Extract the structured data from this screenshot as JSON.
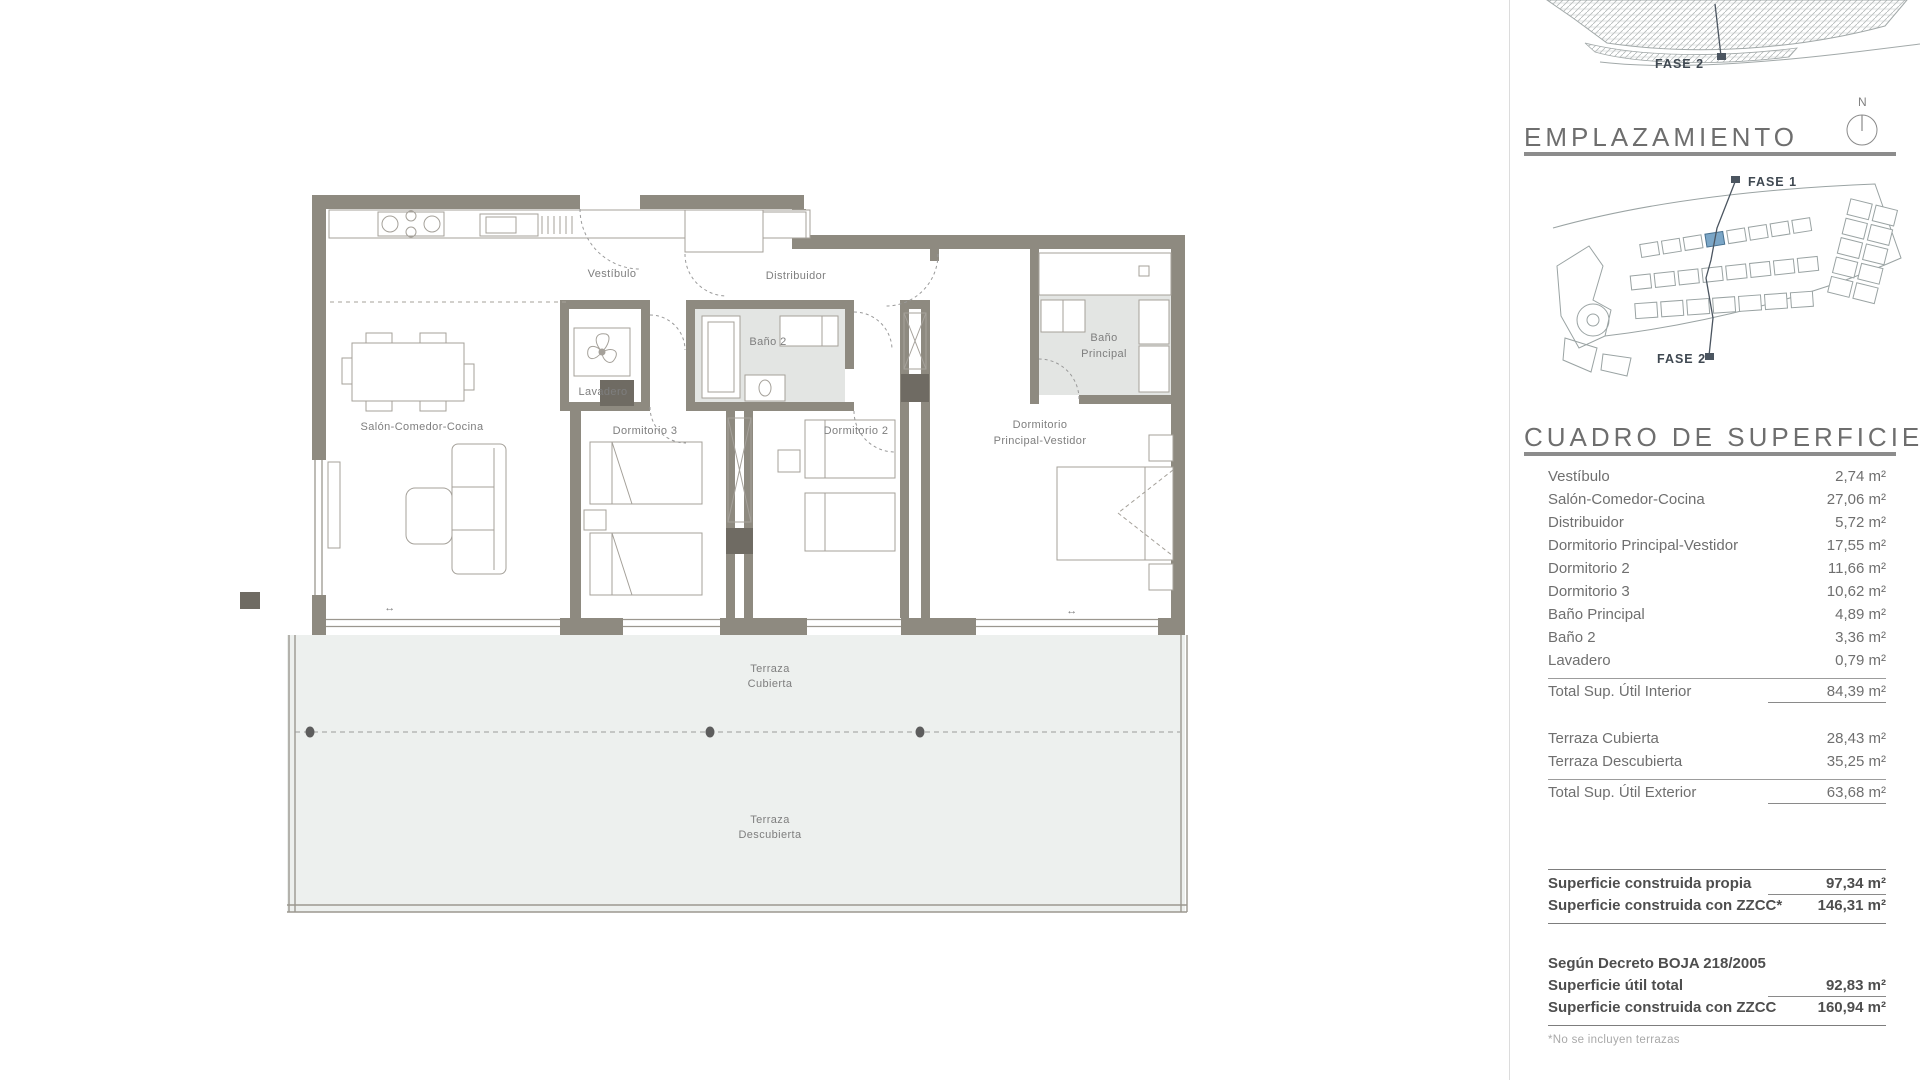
{
  "headings": {
    "emplazamiento": "EMPLAZAMIENTO",
    "cuadro": "CUADRO DE SUPERFICIES"
  },
  "compass": {
    "north": "N"
  },
  "top_map": {
    "fase2": "FASE 2"
  },
  "site_plan": {
    "fase1": "FASE 1",
    "fase2": "FASE 2",
    "highlight_color": "#7ba6c7"
  },
  "floor_plan": {
    "labels": {
      "vestibulo": "Vestíbulo",
      "distribuidor": "Distribuidor",
      "bano2": "Baño 2",
      "lavadero": "Lavadero",
      "salon": "Salón-Comedor-Cocina",
      "dorm3": "Dormitorio 3",
      "dorm2": "Dormitorio 2",
      "dormp1": "Dormitorio",
      "dormp2": "Principal-Vestidor",
      "banop1": "Baño",
      "banop2": "Principal",
      "terraza_c1": "Terraza",
      "terraza_c2": "Cubierta",
      "terraza_d1": "Terraza",
      "terraza_d2": "Descubierta",
      "slide_arrow": "↔"
    },
    "colors": {
      "wall": "#8e8a80",
      "wall_dark": "#6f6b63",
      "terrace_fill": "#edf0ee",
      "bath_floor": "#e3e5e3"
    }
  },
  "surfaces": {
    "interior": [
      {
        "label": "Vestíbulo",
        "value": "2,74 m²"
      },
      {
        "label": "Salón-Comedor-Cocina",
        "value": "27,06 m²"
      },
      {
        "label": "Distribuidor",
        "value": "5,72 m²"
      },
      {
        "label": "Dormitorio Principal-Vestidor",
        "value": "17,55 m²"
      },
      {
        "label": "Dormitorio 2",
        "value": "11,66 m²"
      },
      {
        "label": "Dormitorio 3",
        "value": "10,62 m²"
      },
      {
        "label": "Baño Principal",
        "value": "4,89 m²"
      },
      {
        "label": "Baño 2",
        "value": "3,36 m²"
      },
      {
        "label": "Lavadero",
        "value": "0,79 m²"
      }
    ],
    "interior_total": {
      "label": "Total Sup. Útil Interior",
      "value": "84,39 m²"
    },
    "exterior": [
      {
        "label": "Terraza Cubierta",
        "value": "28,43 m²"
      },
      {
        "label": "Terraza Descubierta",
        "value": "35,25 m²"
      }
    ],
    "exterior_total": {
      "label": "Total Sup. Útil Exterior",
      "value": "63,68 m²"
    },
    "construida": [
      {
        "label": "Superficie construida propia",
        "value": "97,34 m²"
      },
      {
        "label": "Superficie construida con ZZCC*",
        "value": "146,31 m²"
      }
    ],
    "decreto_heading": "Según Decreto BOJA 218/2005",
    "decreto": [
      {
        "label": "Superficie útil total",
        "value": "92,83 m²"
      },
      {
        "label": "Superficie construida con ZZCC",
        "value": "160,94 m²"
      }
    ],
    "footnote": "*No se incluyen terrazas"
  }
}
